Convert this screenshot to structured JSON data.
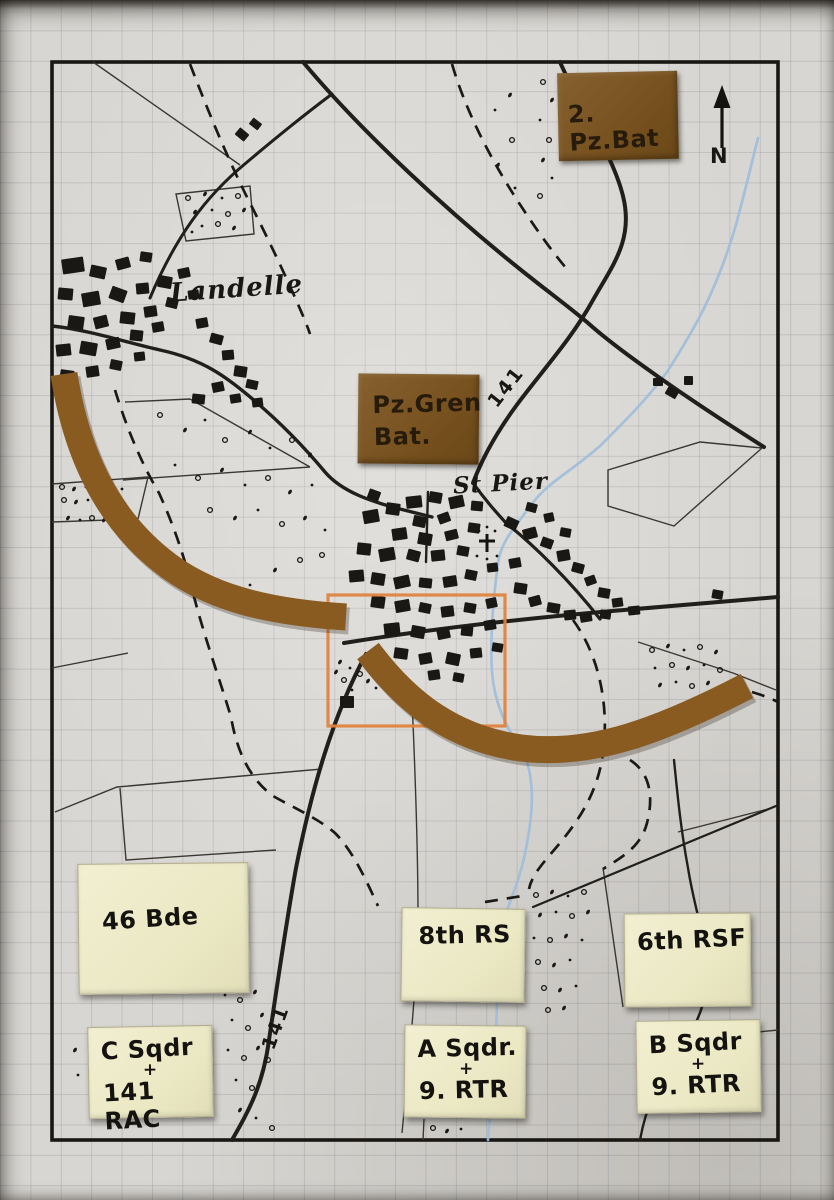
{
  "map": {
    "compass_label": "N",
    "labels": {
      "village": "Landelle",
      "town": "St Pier",
      "road_number_north": "141",
      "road_number_south": "141"
    },
    "german_counters": {
      "panzer_battalion": "2. Pz.Bat",
      "panzergrenadier_line1": "Pz.Gren",
      "panzergrenadier_line2": "Bat."
    },
    "british_cards": {
      "brigade": "46 Bde",
      "recce": "8th RS",
      "fusiliers": "6th RSF",
      "c_squadron_line1": "C Sqdr",
      "c_squadron_line2": "141 RAC",
      "a_squadron_line1": "A Sqdr.",
      "a_squadron_line2": "9. RTR",
      "b_squadron_line1": "B Sqdr",
      "b_squadron_line2": "9. RTR"
    },
    "marks": {
      "squadron_cross": "+"
    },
    "colors": {
      "paper": "#d8d6d2",
      "ink": "#1d1b18",
      "counter_brown": "#7b5428",
      "arc_brown": "#8a5b21",
      "card_cream": "#edeac9",
      "highlight_orange": "#e0813c",
      "stream_blue": "#9fbcdc"
    }
  }
}
